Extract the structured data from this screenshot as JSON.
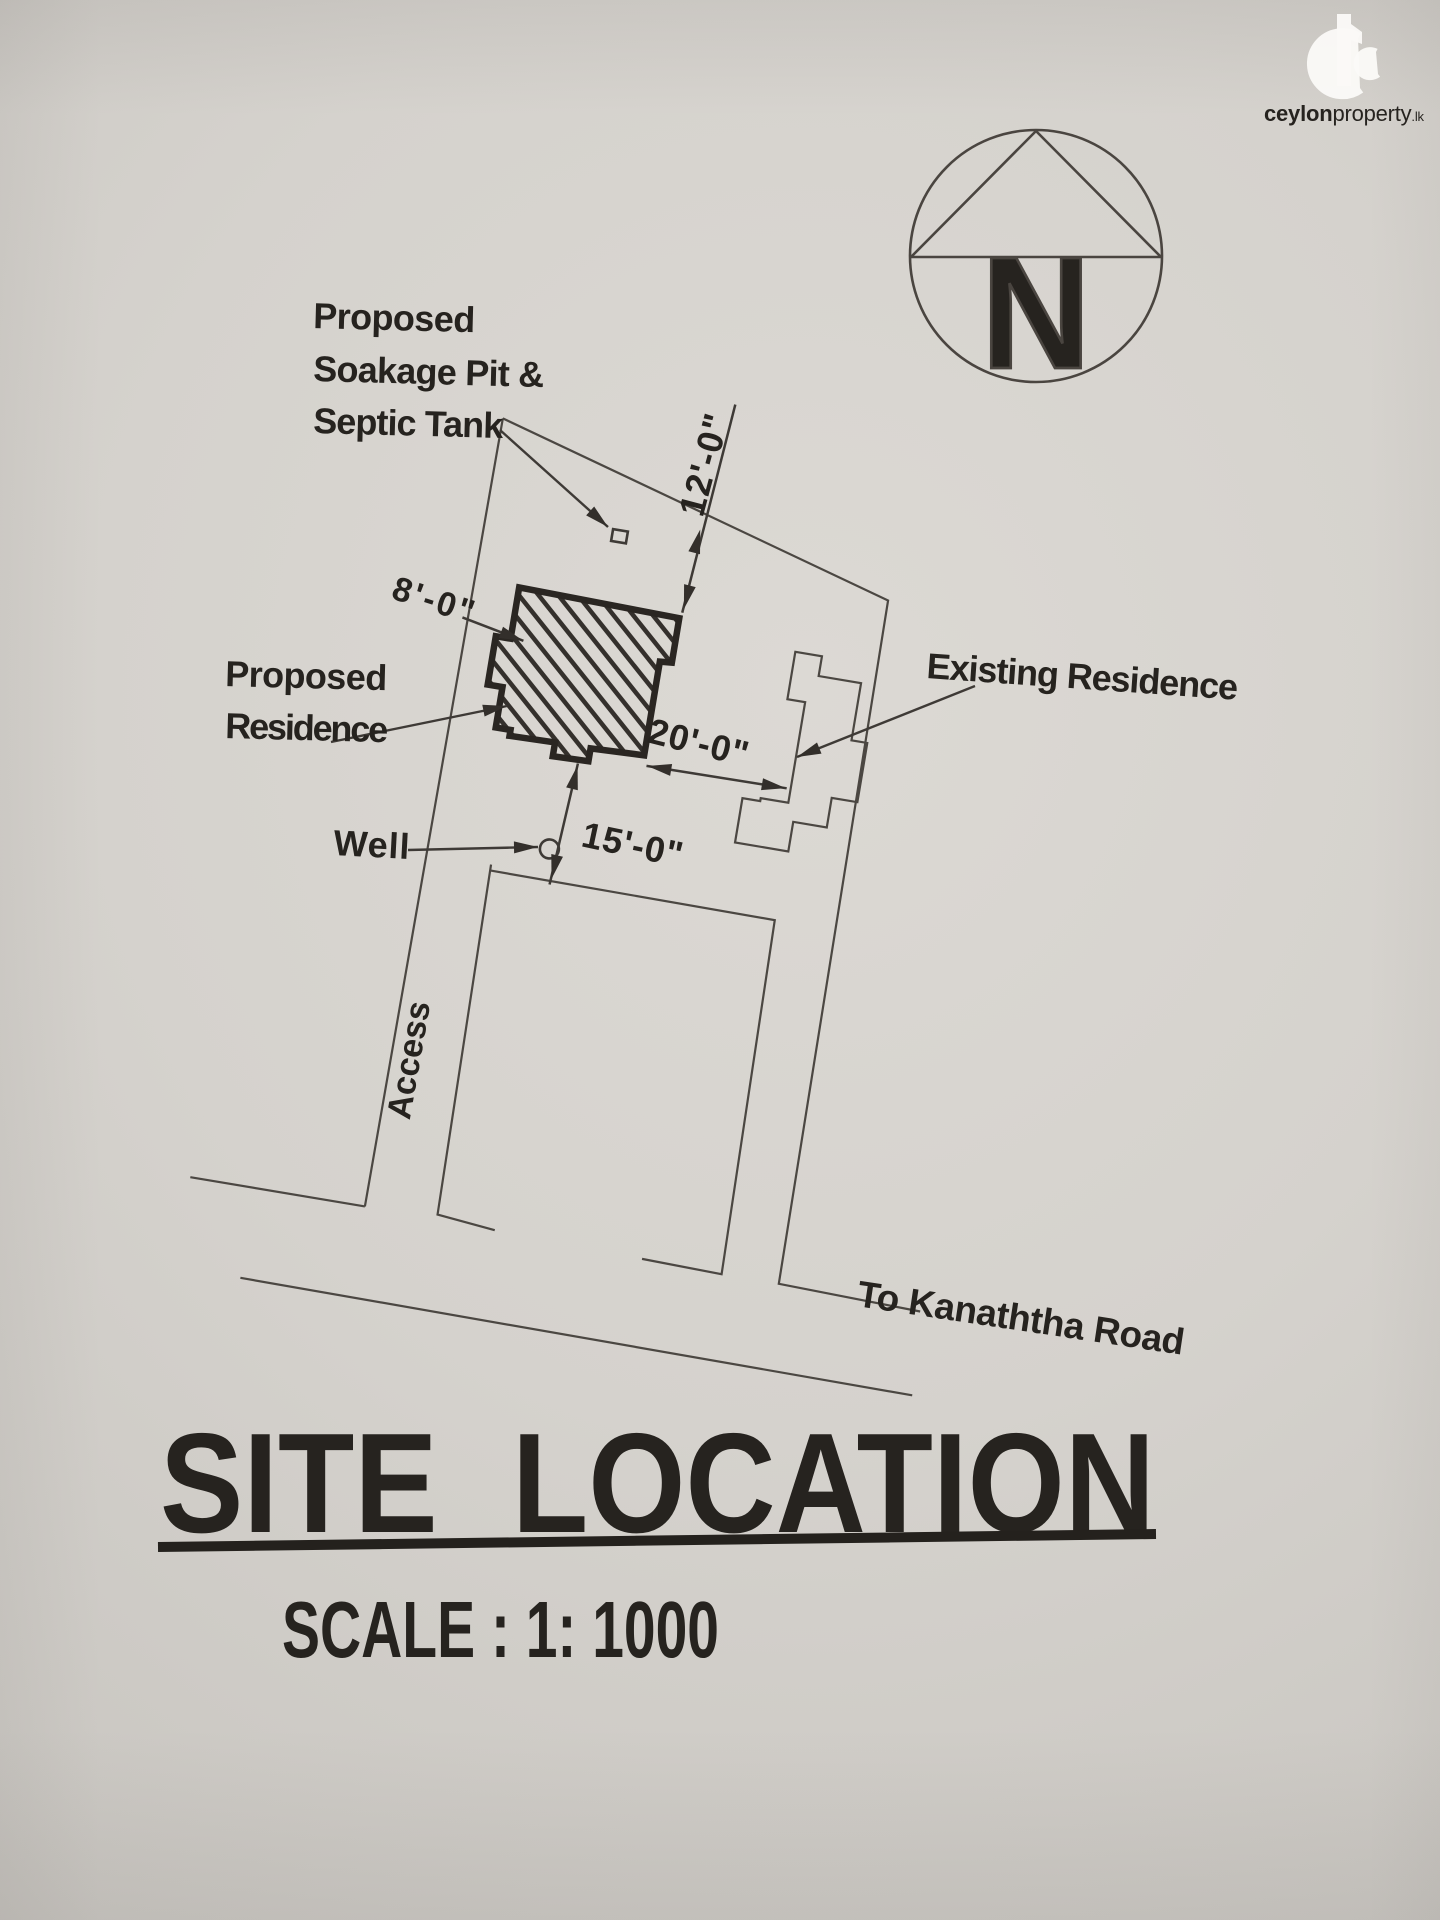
{
  "watermark": {
    "brand_primary": "ceylon",
    "brand_secondary": "property",
    "brand_suffix": ".lk"
  },
  "compass": {
    "letter": "N"
  },
  "plan": {
    "soakage_label": {
      "line1": "Proposed",
      "line2": "Soakage Pit &",
      "line3": "Septic Tank"
    },
    "proposed_label": {
      "line1": "Proposed",
      "line2": "Residence"
    },
    "existing_label": "Existing Residence",
    "well_label": "Well",
    "access_label": "Access",
    "road_label": "To Kanaththa Road",
    "dim_north": "12'-0\"",
    "dim_west": "8'-0\"",
    "dim_east": "20'-0\"",
    "dim_south": "15'-0\""
  },
  "title_block": {
    "title": "SITE LOCATION",
    "scale": "SCALE : 1: 1000"
  }
}
